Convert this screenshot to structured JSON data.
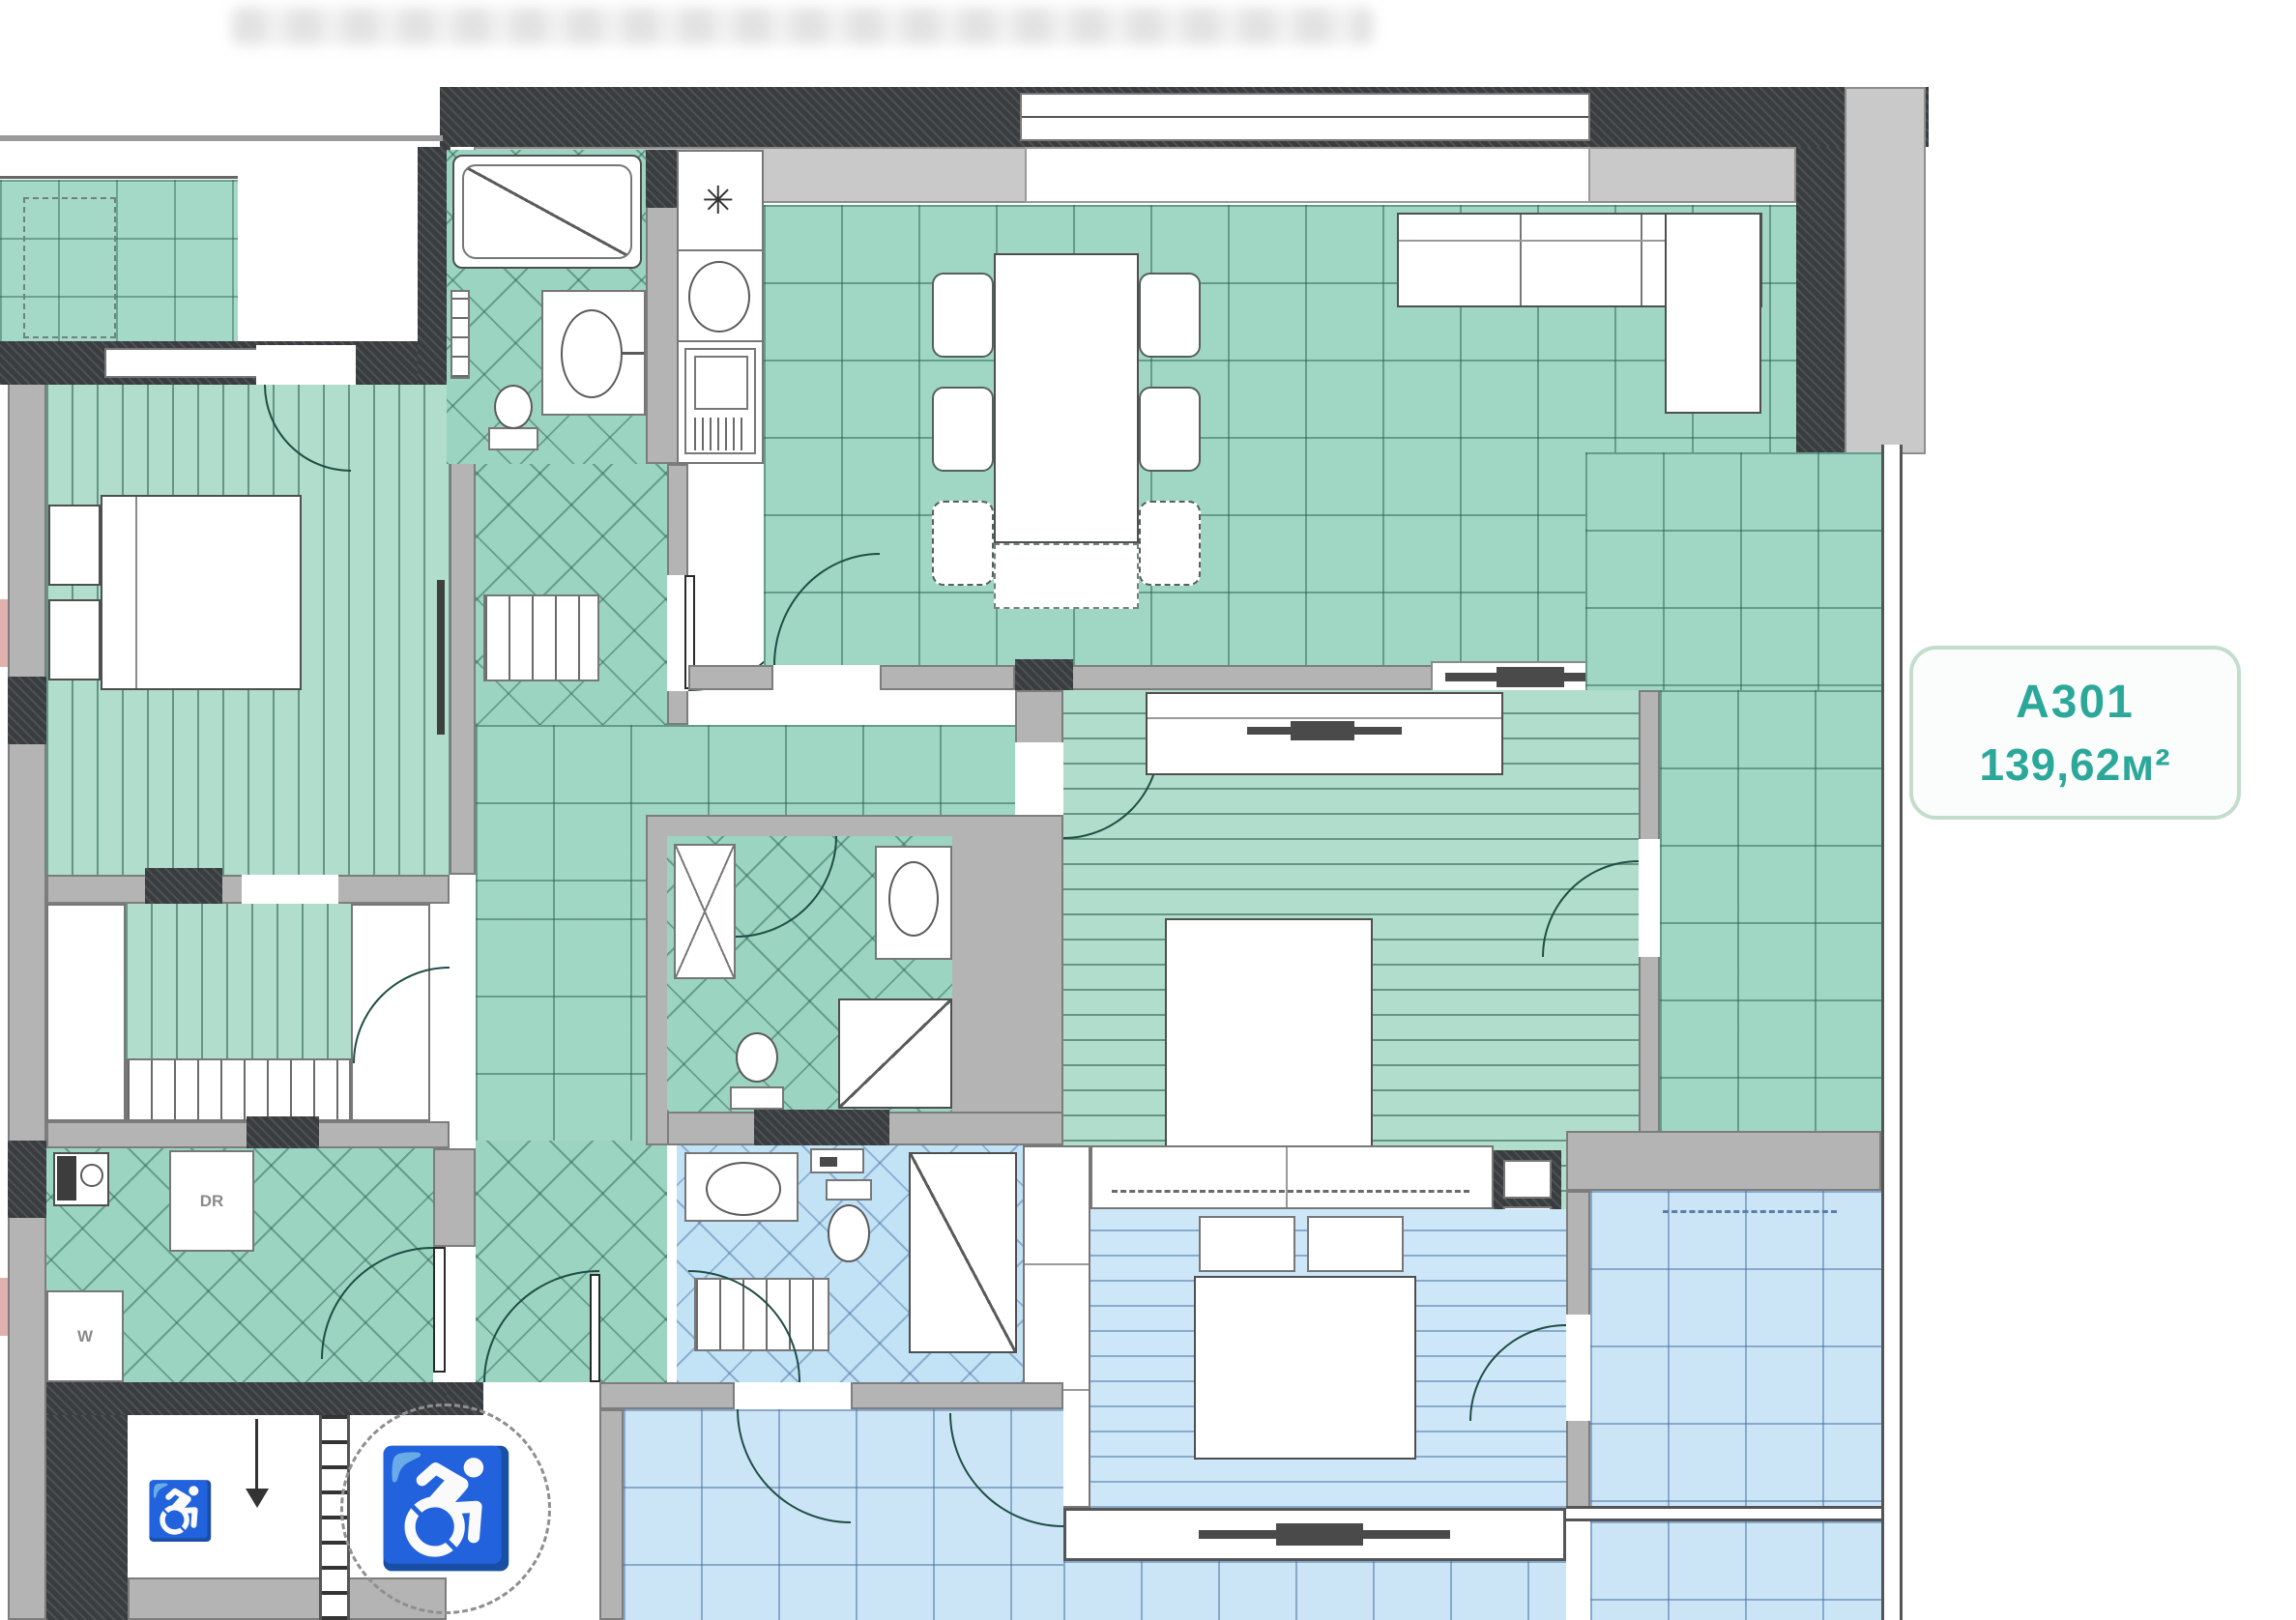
{
  "unit": {
    "code": "A301",
    "area": "139,62м²"
  },
  "laundry": {
    "dryer": "DR",
    "washer": "W"
  },
  "icons": {
    "wheelchair": "♿",
    "fridge_snowflake": "✳"
  },
  "colors": {
    "tile_green": "#9fd7c4",
    "tile_blue": "#cbe5f7",
    "wall_dark": "#3a3d3f",
    "wall_gray": "#b4b4b4",
    "accent_teal": "#2ca89a",
    "door_arc": "#1f4e44"
  }
}
